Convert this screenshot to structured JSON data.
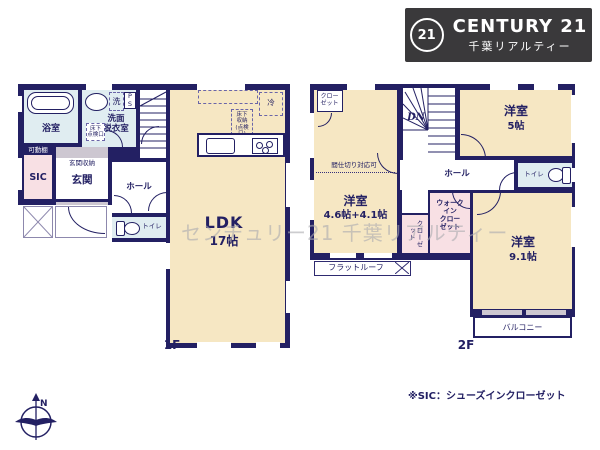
{
  "logo": {
    "mark": "21",
    "brand": "CENTURY 21",
    "company": "千葉リアルティー"
  },
  "watermark": "センチュリー21 千葉リアルティー",
  "note": "※SIC：シューズインクローゼット",
  "compass": {
    "north": "N"
  },
  "colors": {
    "wall": "#232063",
    "cream": "#f6e7c3",
    "water_blue": "#e0edf1",
    "closet_pink": "#f8e0e4",
    "silver": "#cdc7d1",
    "logo_bg": "#3a393b"
  },
  "floor1": {
    "floor_label": "1F",
    "bath": "浴室",
    "ps": "P\nS",
    "washer": "洗",
    "washroom": "洗面\n脱衣室",
    "inspection": "床下\n点検口",
    "movable_shelf": "可動棚",
    "sic": "SIC",
    "entrance_storage": "玄関収納",
    "entrance": "玄関",
    "hall": "ホール",
    "toilet": "トイレ",
    "up": "UP",
    "fridge": "冷",
    "floor_storage": "床下\n収納\n(点検口)",
    "ldk": "LDK",
    "ldk_size": "17帖"
  },
  "floor2": {
    "floor_label": "2F",
    "closet_top": "クロー\nゼット",
    "partition": "間仕切り対応可",
    "room_w": "洋室",
    "room_w_size": "4.6帖+4.1帖",
    "dn": "DN",
    "hall": "ホール",
    "room5": "洋室",
    "room5_size": "5帖",
    "toilet": "トイレ",
    "wic": "ウォーク\nイン\nクロー\nゼット",
    "closet_small": "クローゼット",
    "room91": "洋室",
    "room91_size": "9.1帖",
    "flatroof": "フラットルーフ",
    "balcony": "バルコニー"
  }
}
